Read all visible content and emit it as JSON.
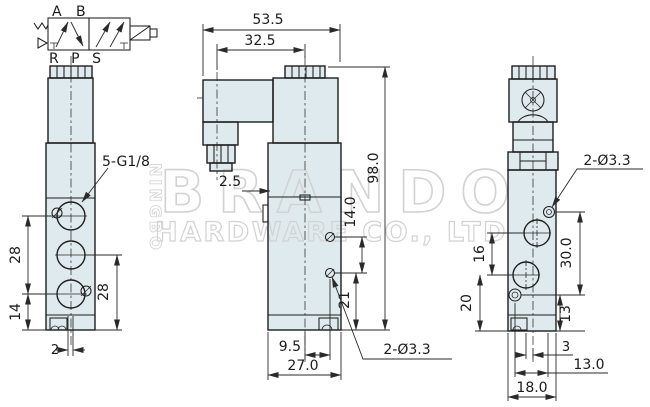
{
  "watermark": {
    "brand": "BRANDO",
    "company": "HARDWARE CO., LTD",
    "city": "NINGBO"
  },
  "symbol": {
    "top_ports": "A B",
    "bottom_ports": "R P S"
  },
  "views": {
    "front": {
      "thread_label": "5-G1/8",
      "dims": {
        "port_pitch": "28",
        "bottom_port": "14",
        "right_port_pitch": "28",
        "slot_width": "2"
      }
    },
    "side": {
      "hole_label": "2-Ø3.3",
      "dims": {
        "overall_width": "53.5",
        "axis_offset": "32.5",
        "step": "2.5",
        "overall_height": "98.0",
        "hole_pitch": "14.0",
        "hole_to_bottom": "21",
        "axis_to_hole": "9.5",
        "depth": "27.0"
      }
    },
    "back": {
      "hole_label": "2-Ø3.3",
      "dims": {
        "port_pitch": "16",
        "bottom_port": "20",
        "hole_pitch_v": "30.0",
        "hole_to_bottom": "13",
        "offset": "3",
        "hole_pitch_h": "13.0",
        "width": "18.0"
      }
    }
  },
  "colors": {
    "line": "#1e1e1e",
    "body_fill": "#dfeaee",
    "watermark": "#d2d2d2",
    "background": "#ffffff"
  }
}
